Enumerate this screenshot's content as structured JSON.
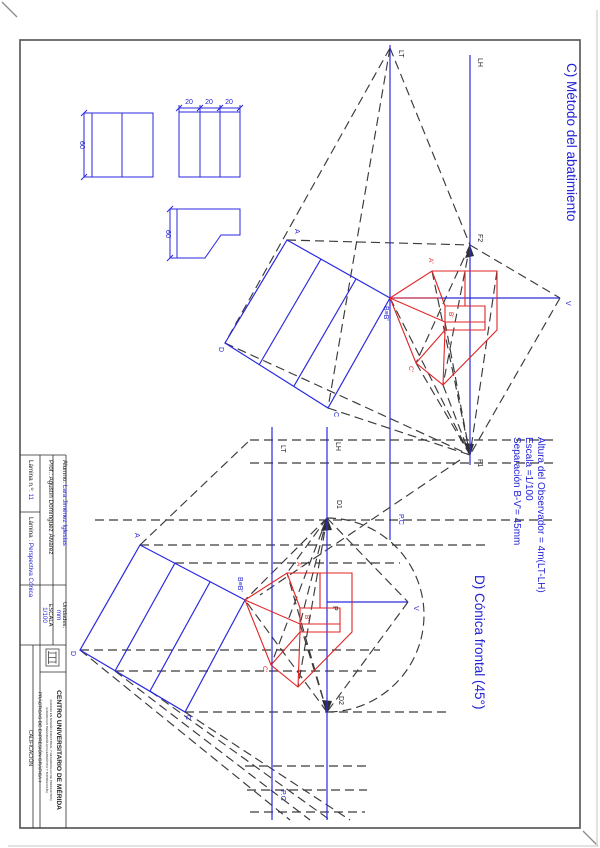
{
  "section_c": {
    "title": "C) Método del abatimiento"
  },
  "section_d": {
    "title": "D) Cónica frontal (45°)"
  },
  "notes": {
    "altura": "Altura del Observador = 4m(LT-LH)",
    "escala": "Escala =1/100",
    "separacion": "Separación B-V'= 45mm"
  },
  "labels": {
    "lt": "LT",
    "lh": "LH",
    "pc": "P.C",
    "f1": "F1",
    "f2": "F2",
    "v": "V",
    "d1": "D1",
    "d2": "D2",
    "p": "P",
    "a": "A",
    "b": "B≡B'",
    "c": "C",
    "d": "D",
    "a_prime": "A'",
    "b_prime": "B'",
    "c_prime": "C'"
  },
  "dimensions": {
    "total": "60",
    "seg": "20"
  },
  "title_block": {
    "alumno_label": "Alumno: ",
    "alumno_value": "Lara Jiménez Iglesias",
    "prof_label": "Prof.: ",
    "prof_value": "Agustín Domínguez Álvarez",
    "lamina_num_label": "Lámina n.º: ",
    "lamina_num_value": "11",
    "lamina_label": "Lámina : ",
    "lamina_value": "Perspectiva Cónica",
    "unidades_label": "Unidades:",
    "unidades_value": "mm",
    "escala_label": "ESCALA",
    "escala_value": "1/100",
    "centro": "CENTRO UNIVERSITARIO DE MÉRIDA",
    "grados_1": "(GRADO EN DISEÑO INDUSTRIAL Y DESARROLLO DE PRODUCTOS)",
    "grados_2": "(GRADO EN INGENIERÍA EN GEOMÁTICA Y TOPOGRAFÍA)",
    "practicas": "PRÁCTICAS DE EXPRESIÓN GRÁFICA-I",
    "calificacion": "CALIFICACIÓN"
  },
  "colors": {
    "blue": "#2222d6",
    "red": "#e02020",
    "construction": "#3a3a3a"
  }
}
